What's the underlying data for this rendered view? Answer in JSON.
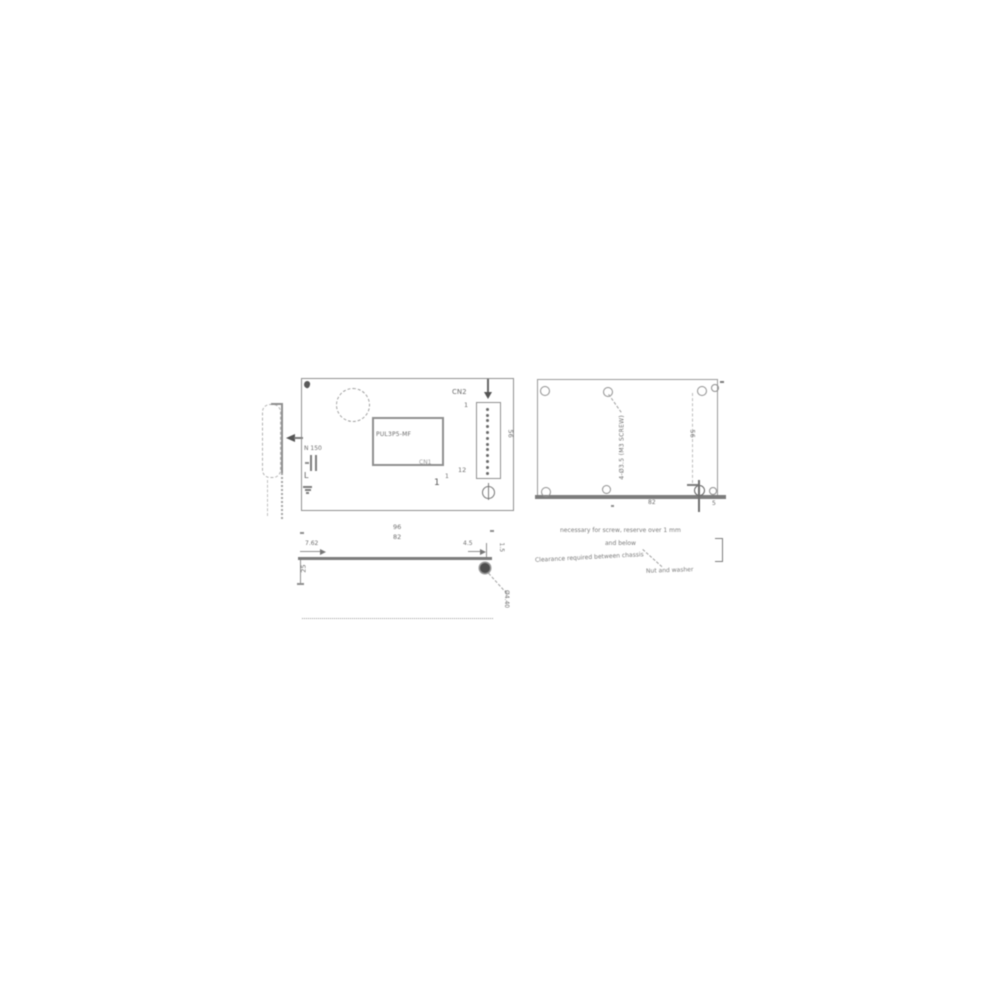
{
  "colors": {
    "line": "#8f8f8f",
    "line_dark": "#7c7c7c",
    "text": "#6e6e6e",
    "ink": "#555555",
    "background": "#ffffff"
  },
  "icons": {
    "view_arrow": "left-triangle",
    "down_arrow": "down-triangle",
    "position_mark": "circle-with-line",
    "screw_head": "filled-circle",
    "ground": "ground-bars"
  },
  "top_view": {
    "component_label": "PUL3P5-MF",
    "cn2_label": "CN2",
    "cn2_pin_first": "1",
    "cn2_pin_last": "12",
    "cn2_pin_count": 12,
    "cn1_label": "CN1",
    "cn1_pin": "1",
    "cn1_pin_sup": "1",
    "input_label": "N 150",
    "input_l": "L",
    "dim_height": "56"
  },
  "plate_view": {
    "hole_note": "4-Ø3.5 (M3 SCREW)",
    "dim_width": "82",
    "dim_edge": "5",
    "dim_height": "56"
  },
  "front_view": {
    "dim_overall": "96",
    "dim_pitch": "82",
    "dim_left": "7.62",
    "dim_right": "4.5",
    "dim_corner": "1.5",
    "dim_side_height": "25",
    "screw_dim": "Ø4.40"
  },
  "notes": {
    "line1": "necessary for screw, reserve over 1 mm",
    "line2": "and below",
    "line3": "Clearance required between chassis",
    "line4": "Nut and washer"
  }
}
